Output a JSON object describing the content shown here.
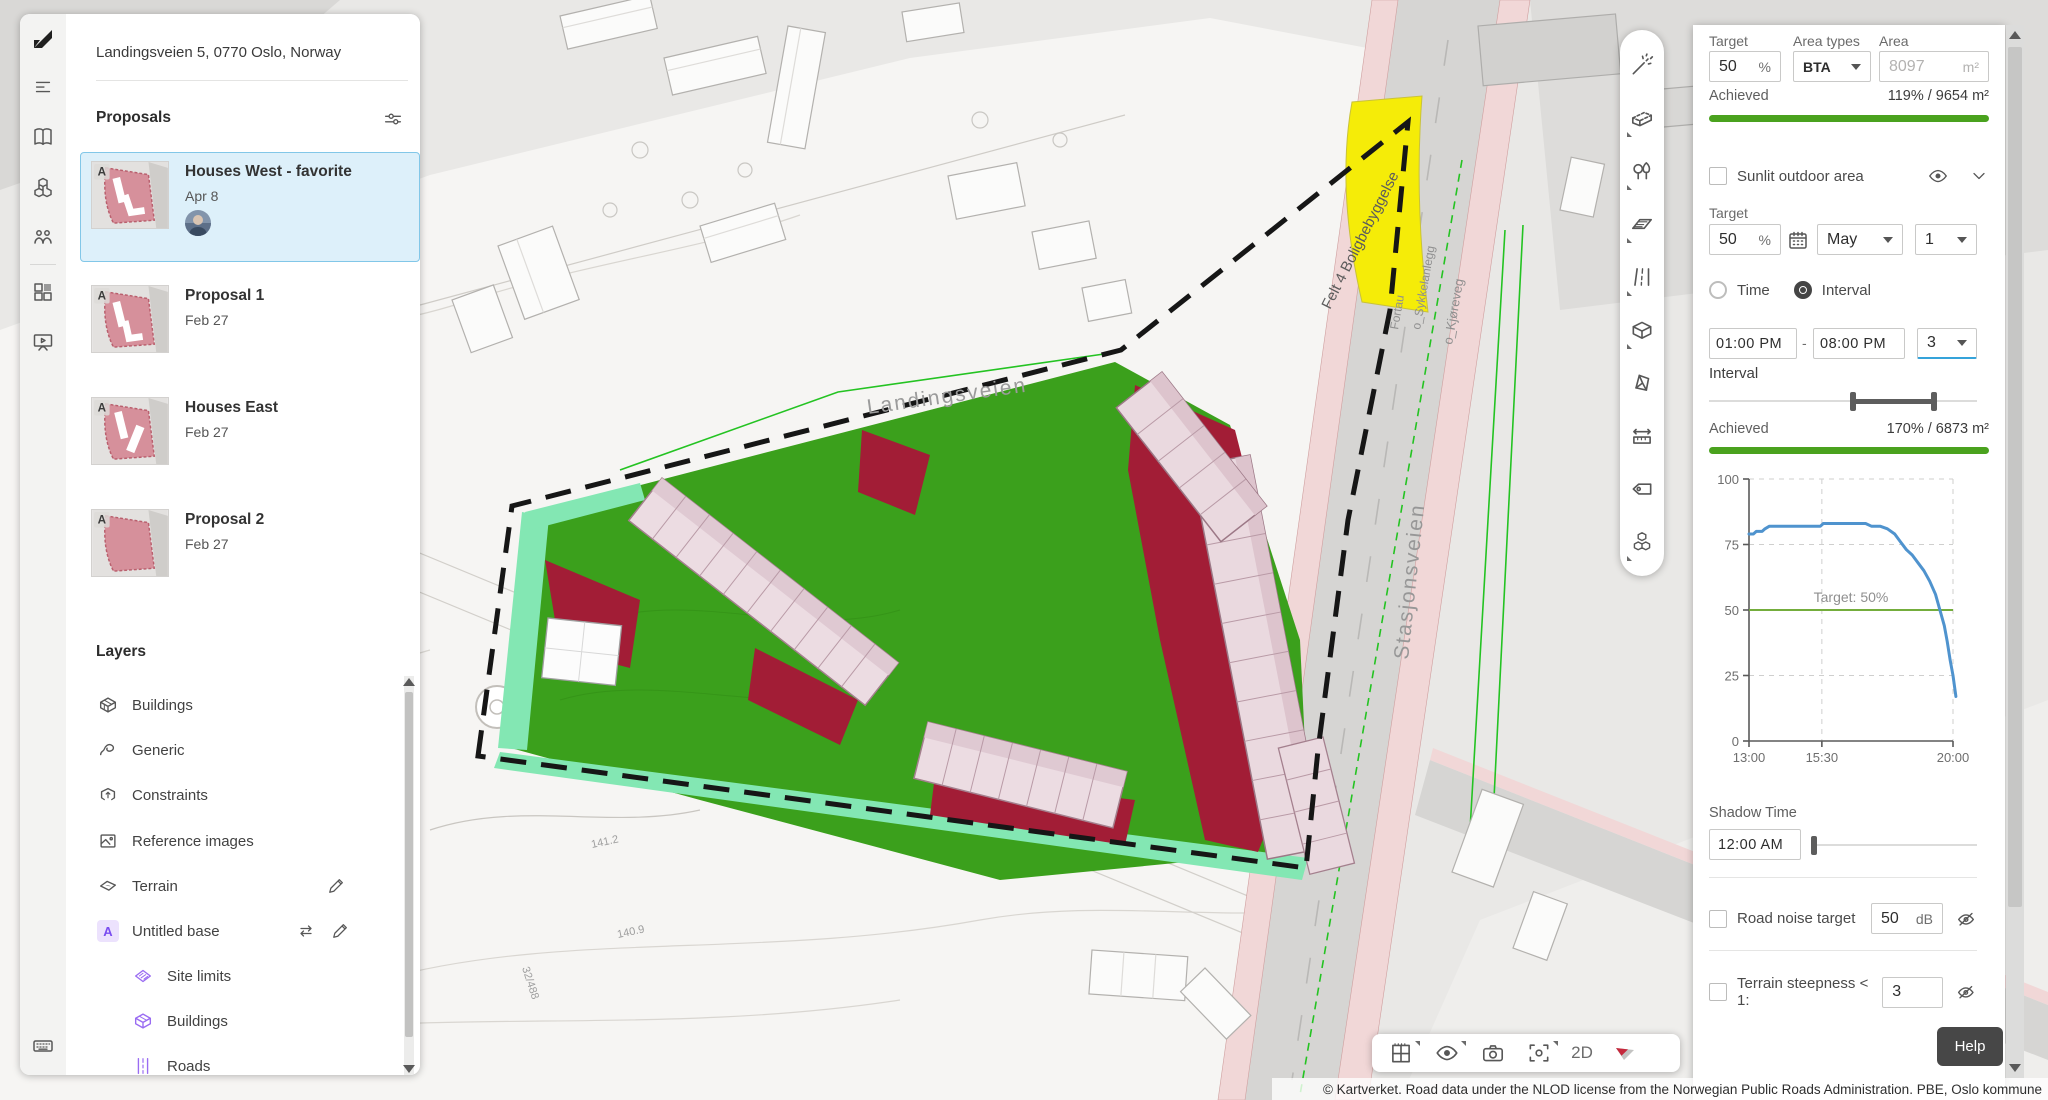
{
  "app": {
    "name": "Forma"
  },
  "left_rail": {
    "icons": [
      "forma-logo",
      "proposals-panel",
      "library",
      "assets",
      "collaboration",
      "apps-grid",
      "present",
      "keyboard-shortcuts"
    ]
  },
  "left_panel": {
    "address": "Landingsveien 5, 0770 Oslo, Norway",
    "proposals": {
      "title": "Proposals",
      "toolbar_icons": [
        "filter-sliders",
        "add-proposal"
      ],
      "items": [
        {
          "badge": "A",
          "title": "Houses West - favorite",
          "date": "Apr 8",
          "selected": true,
          "has_avatar": true
        },
        {
          "badge": "A",
          "title": "Proposal 1",
          "date": "Feb 27",
          "selected": false,
          "has_avatar": false
        },
        {
          "badge": "A",
          "title": "Houses East",
          "date": "Feb 27",
          "selected": false,
          "has_avatar": false
        },
        {
          "badge": "A",
          "title": "Proposal 2",
          "date": "Feb 27",
          "selected": false,
          "has_avatar": false
        }
      ]
    },
    "layers": {
      "title": "Layers",
      "items": [
        {
          "label": "Buildings",
          "icon": "buildings-icon",
          "indent": 0,
          "color": "gray"
        },
        {
          "label": "Generic",
          "icon": "generic-icon",
          "indent": 0,
          "color": "gray"
        },
        {
          "label": "Constraints",
          "icon": "constraints-icon",
          "indent": 0,
          "color": "gray"
        },
        {
          "label": "Reference images",
          "icon": "reference-images-icon",
          "indent": 0,
          "color": "gray"
        },
        {
          "label": "Terrain",
          "icon": "terrain-icon",
          "indent": 0,
          "color": "gray",
          "actions": [
            "edit"
          ]
        },
        {
          "label": "Untitled base",
          "icon": "a-badge",
          "badge": "A",
          "indent": 0,
          "color": "purple",
          "actions": [
            "swap",
            "edit"
          ]
        },
        {
          "label": "Site limits",
          "icon": "site-limits-icon",
          "indent": 1,
          "color": "purple"
        },
        {
          "label": "Buildings",
          "icon": "buildings-icon",
          "indent": 1,
          "color": "purple"
        },
        {
          "label": "Roads",
          "icon": "roads-icon",
          "indent": 1,
          "color": "purple"
        }
      ]
    }
  },
  "right_toolbar": {
    "tools": [
      "magic-wand",
      "building",
      "vegetation",
      "zone",
      "road",
      "volume",
      "prism",
      "measure",
      "label-tag",
      "blocks"
    ]
  },
  "right_panel": {
    "area_section": {
      "target_label": "Target",
      "target_value": "50",
      "target_unit": "%",
      "area_types_label": "Area types",
      "area_type_value": "BTA",
      "area_label": "Area",
      "area_value": "8097",
      "area_unit": "m²",
      "achieved_label": "Achieved",
      "achieved_value": "119% / 9654 m²",
      "bar_color": "#4aa21e"
    },
    "sunlit_section": {
      "title": "Sunlit outdoor area",
      "checked": false,
      "target_label": "Target",
      "target_value": "50",
      "target_unit": "%",
      "month_value": "May",
      "day_value": "1",
      "radio_time_label": "Time",
      "radio_interval_label": "Interval",
      "radio_selected": "Interval",
      "time_from": "01:00 PM",
      "time_separator": "-",
      "time_to": "08:00 PM",
      "interval_hours": "3",
      "interval_label": "Interval",
      "achieved_label": "Achieved",
      "achieved_value": "170% / 6873 m²",
      "bar_color": "#4aa21e"
    },
    "shadow_section": {
      "label": "Shadow Time",
      "time_value": "12:00 AM"
    },
    "road_noise": {
      "label": "Road noise target",
      "checked": false,
      "value": "50",
      "unit": "dB"
    },
    "terrain_steepness": {
      "label": "Terrain steepness < 1:",
      "checked": false,
      "value": "3"
    },
    "help_label": "Help"
  },
  "bottom_toolbar": {
    "tools": [
      "area-plan",
      "visibility",
      "camera",
      "focus-selection"
    ],
    "mode_label": "2D",
    "compass": "north-arrow"
  },
  "map": {
    "labels": {
      "street_main": "Landingsveien",
      "street_station": "Stasjonsveien",
      "zone": "Felt 4 Boligbebyggelse",
      "lane1": "Fortau",
      "lane2": "o_Sykkelanlegg",
      "lane3": "o_Kjøreveg",
      "parcel1": "141.2",
      "parcel2": "140.9",
      "parcel3": "32/488"
    },
    "attribution": "© Kartverket. Road data under the NLOD license from the Norwegian Public Roads Administration. PBE, Oslo kommune",
    "colors": {
      "site_green": "#3ba01c",
      "mint": "#83e7b3",
      "red_zone": "#a21d36",
      "yellow_zone": "#f5ec08",
      "building_pink": "#ead9df",
      "road_pink": "#f1d7d7"
    }
  },
  "chart_data": {
    "type": "line",
    "title": "",
    "xlabel": "",
    "ylabel": "",
    "x_ticks": [
      "13:00",
      "15:30",
      "20:00"
    ],
    "x_tick_values": [
      13,
      15.5,
      20
    ],
    "y_ticks": [
      0,
      25,
      50,
      75,
      100
    ],
    "xlim": [
      13,
      20.15
    ],
    "ylim": [
      0,
      100
    ],
    "grid": "dashed",
    "legend": "none",
    "target": {
      "value": 50,
      "label": "Target: 50%",
      "color": "#74ad3c"
    },
    "series": [
      {
        "name": "sunlit_percent",
        "color": "#4f93ce",
        "points": [
          [
            13,
            79
          ],
          [
            13.15,
            79
          ],
          [
            13.25,
            80
          ],
          [
            13.45,
            80
          ],
          [
            13.55,
            81
          ],
          [
            13.7,
            82
          ],
          [
            14,
            82
          ],
          [
            14.5,
            82
          ],
          [
            15,
            82
          ],
          [
            15.45,
            82
          ],
          [
            15.55,
            83
          ],
          [
            16,
            83
          ],
          [
            16.5,
            83
          ],
          [
            17,
            83
          ],
          [
            17.2,
            82
          ],
          [
            17.5,
            82
          ],
          [
            17.75,
            81
          ],
          [
            18,
            79
          ],
          [
            18.2,
            76
          ],
          [
            18.4,
            73
          ],
          [
            18.6,
            71
          ],
          [
            18.8,
            68
          ],
          [
            19,
            65
          ],
          [
            19.2,
            61
          ],
          [
            19.4,
            56
          ],
          [
            19.55,
            50
          ],
          [
            19.7,
            44
          ],
          [
            19.8,
            38
          ],
          [
            19.9,
            31
          ],
          [
            20,
            25
          ],
          [
            20.1,
            17
          ]
        ]
      }
    ]
  }
}
